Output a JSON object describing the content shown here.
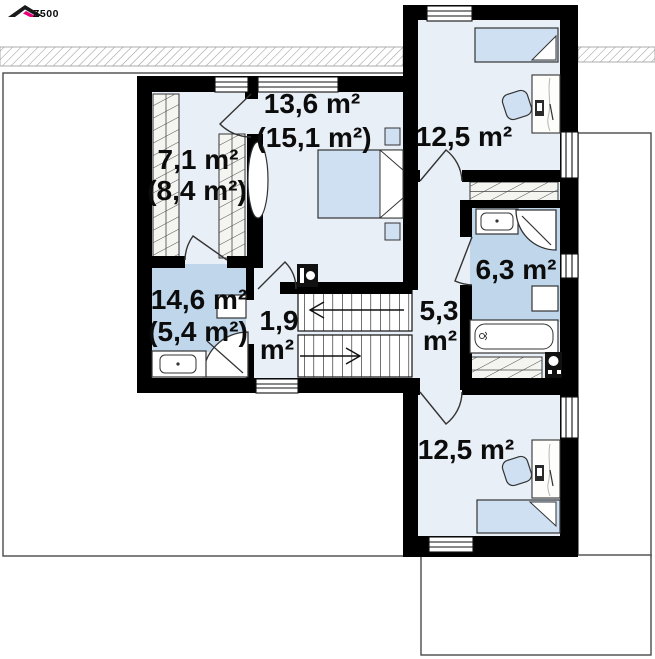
{
  "logo": {
    "brand": "Z500",
    "accent_color": "#e6007e"
  },
  "plan_title": "second-floor plan",
  "rooms": {
    "wardrobe": {
      "line1": "7,1 m²",
      "line2": "(8,4 m²)"
    },
    "bedroom1": {
      "line1": "13,6 m²",
      "line2": "(15,1 m²)"
    },
    "bedroom2": {
      "line1": "12,5 m²"
    },
    "bathroom1": {
      "line1": "14,6 m²",
      "line2": "(5,4 m²)"
    },
    "corridor": {
      "line1": "1,9",
      "line2": "m²"
    },
    "hall": {
      "line1": "5,3",
      "line2": "m²"
    },
    "bathroom2": {
      "line1": "6,3 m²"
    },
    "bedroom3": {
      "line1": "12,5 m²"
    }
  },
  "colors": {
    "wall": "#000000",
    "floor": "#e9eff7",
    "bath_floor": "#bfd6eb",
    "furniture_blue": "#cfe0f2",
    "outline": "#333333",
    "roof_outline": "#4a4a4a",
    "accent": "#e6007e"
  }
}
